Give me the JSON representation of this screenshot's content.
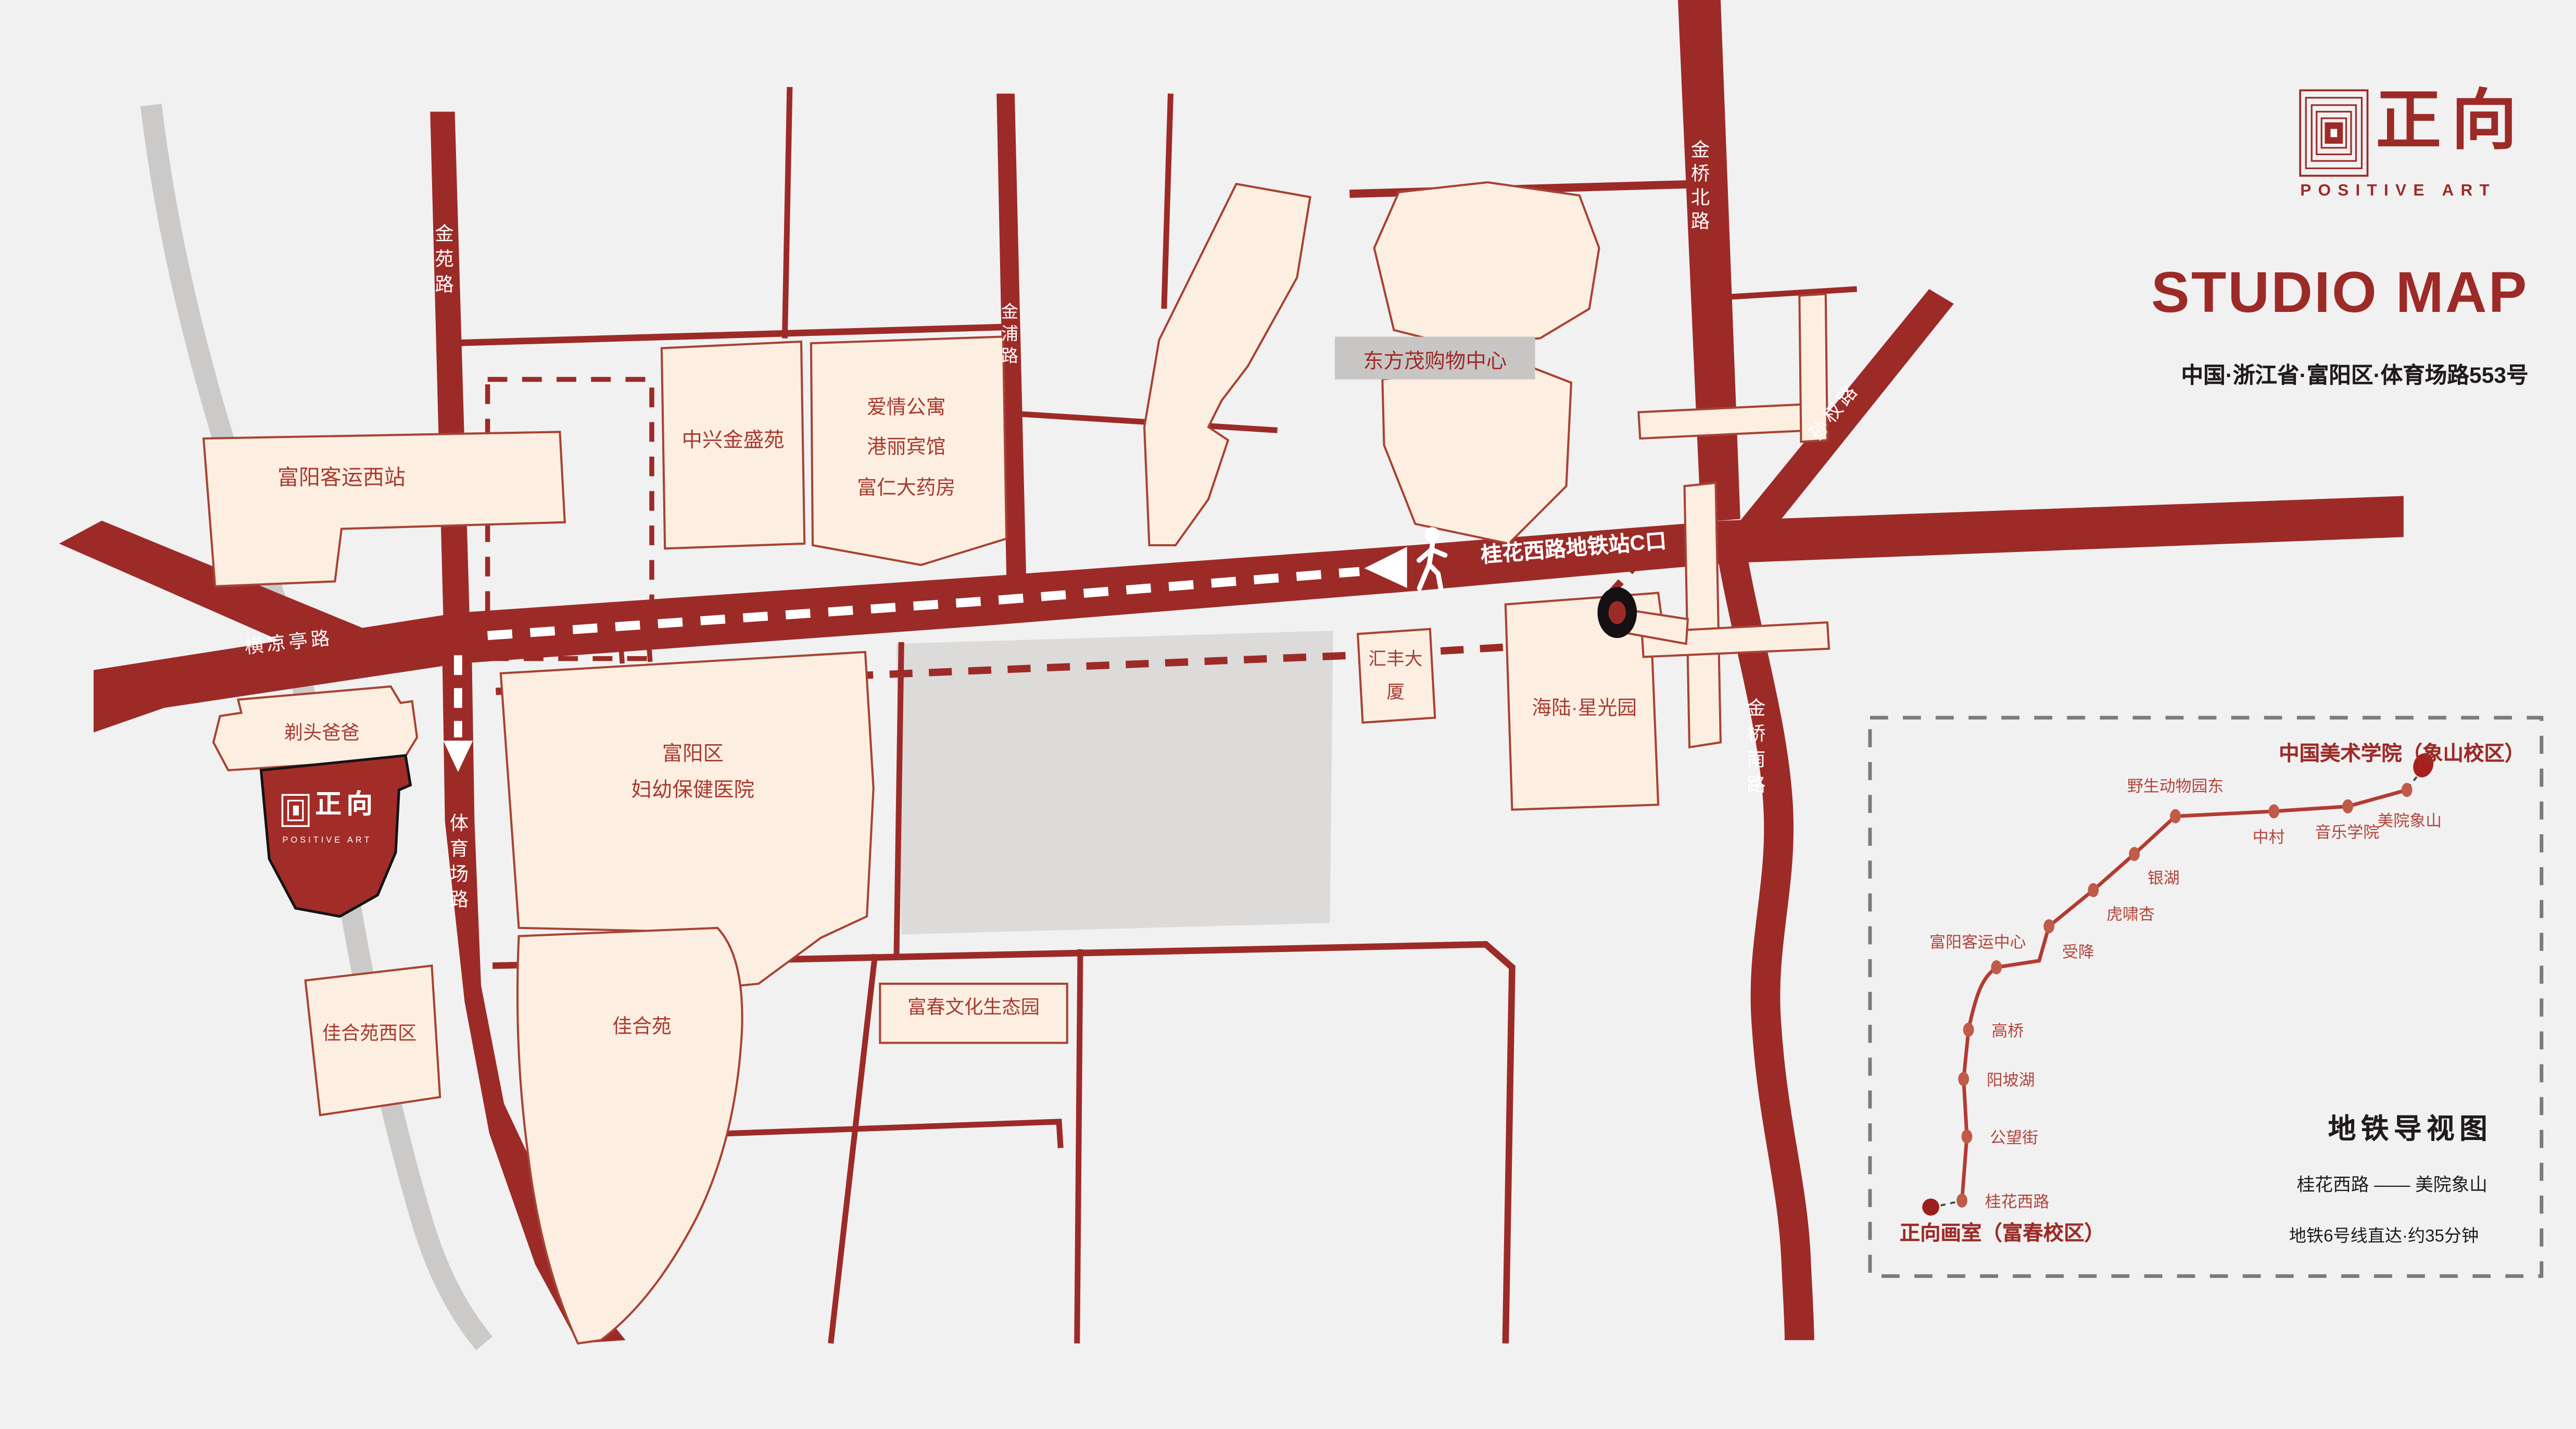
{
  "branding": {
    "logo_zh": "正向",
    "logo_en": "POSITIVE ART",
    "title": "STUDIO MAP",
    "address": "中国·浙江省·富阳区·体育场路553号"
  },
  "roads": {
    "jinyuan": "金苑路",
    "jinpu": "金浦路",
    "jinqiao_north": "金桥北路",
    "sunquan": "孙权路",
    "jinqiao_south": "金桥南路",
    "hengliangting": "横凉亭路",
    "tiyuchang": "体育场路"
  },
  "route": {
    "exit_label": "桂花西路地铁站C口"
  },
  "buildings": {
    "west_station": "富阳客运西站",
    "zhongxing": "中兴金盛苑",
    "apartment": "爱情公寓",
    "hotel": "港丽宾馆",
    "pharmacy": "富仁大药房",
    "mall": "东方茂购物中心",
    "huifeng": "汇丰大厦",
    "hailu": "海陆·星光园",
    "hospital_l1": "富阳区",
    "hospital_l2": "妇幼保健医院",
    "titou": "剃头爸爸",
    "jiahe_west": "佳合苑西区",
    "jiahe": "佳合苑",
    "eco_park": "富春文化生态园"
  },
  "studio": {
    "zh": "正向",
    "en": "POSITIVE ART"
  },
  "inset": {
    "campus": "中国美术学院（象山校区）",
    "studio": "正向画室（富春校区）",
    "title": "地铁导视图",
    "route": "桂花西路 —— 美院象山",
    "note": "地铁6号线直达·约35分钟",
    "stations": [
      "桂花西路",
      "公望街",
      "阳坡湖",
      "高桥",
      "富阳客运中心",
      "受降",
      "虎啸杏",
      "银湖",
      "野生动物园东",
      "中村",
      "音乐学院",
      "美院象山"
    ]
  }
}
